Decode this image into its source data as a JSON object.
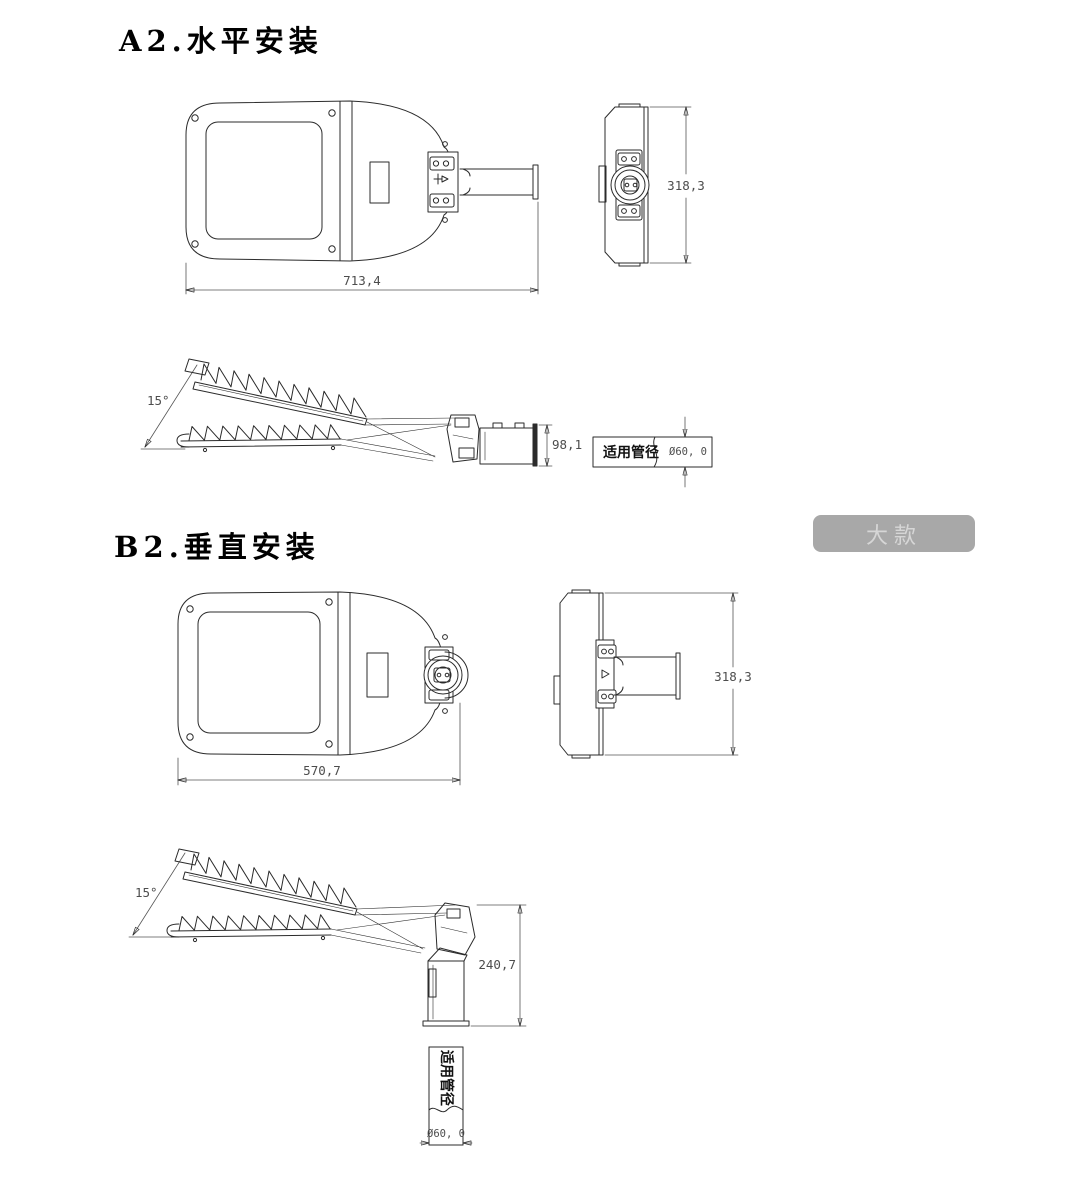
{
  "page": {
    "background": "#ffffff"
  },
  "colors": {
    "line": "#2b2b2b",
    "dim_text": "#4d4d4d",
    "badge_bg": "#a8a8a8",
    "badge_text": "#d6d6d6"
  },
  "section_a2": {
    "title": "A2.水平安装",
    "top_view": {
      "length_dim": "713,4"
    },
    "end_view": {
      "height_dim": "318,3"
    },
    "profile_view": {
      "tilt_angle_dim": "15°",
      "head_height_dim": "98,1"
    },
    "pipe_section": {
      "label": "适用管径",
      "diameter_dim": "Ø60, 0"
    }
  },
  "section_b2": {
    "title": "B2.垂直安装",
    "top_view": {
      "length_dim": "570,7"
    },
    "end_view": {
      "height_dim": "318,3"
    },
    "profile_view": {
      "tilt_angle_dim": "15°",
      "mount_height_dim": "240,7"
    },
    "pipe_section": {
      "label": "适用管径",
      "diameter_dim": "Ø60, 0"
    }
  },
  "size_badge": {
    "label": "大款"
  }
}
